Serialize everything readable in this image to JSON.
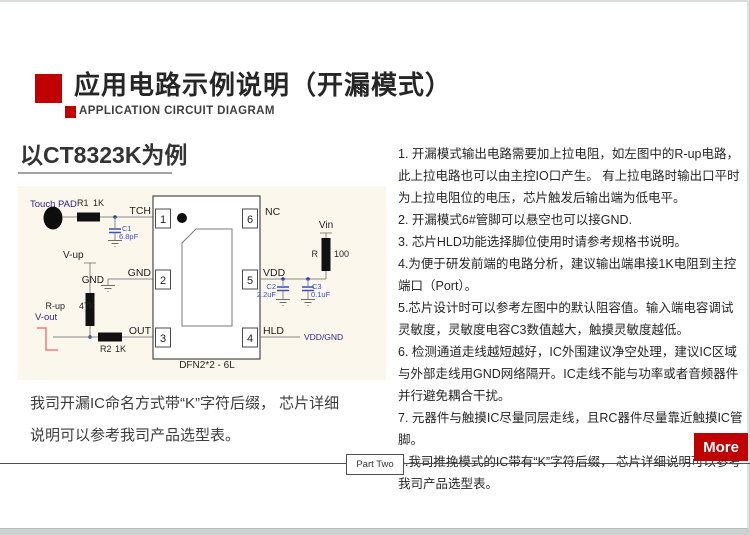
{
  "header": {
    "title": "应用电路示例说明（开漏模式）",
    "subtitle": "APPLICATION CIRCUIT DIAGRAM"
  },
  "left": {
    "heading": "以CT8323K为例",
    "caption_lines": [
      "我司开漏IC命名方式带“K”字符后缀， 芯片详细",
      "说明可以参考我司产品选型表。"
    ]
  },
  "notes": [
    "1. 开漏模式输出电路需要加上拉电阻，如左图中的R-up电路，此上拉电路也可以由主控IO口产生。 有上拉电路时输出口平时为上拉电阻位的电压，芯片触发后输出端为低电平。",
    "2. 开漏模式6#管脚可以悬空也可以接GND.",
    "3. 芯片HLD功能选择脚位使用时请参考规格书说明。",
    "4.为便于研发前端的电路分析，建议输出端串接1K电阻到主控端口（Port）。",
    "5.芯片设计时可以参考左图中的默认阻容值。输入端电容调试灵敏度，灵敏度电容C3数值越大，触摸灵敏度越低。",
    "6. 检测通道走线越短越好，IC外围建议净空处理，建议IC区域与外部走线用GND网络隔开。IC走线不能与功率或者音频器件并行避免耦合干扰。",
    "7. 元器件与触摸IC尽量同层走线，且RC器件尽量靠近触摸IC管脚。",
    "8.我司推挽模式的IC带有“K”字符后缀， 芯片详细说明可以参考我司产品选型表。"
  ],
  "footer": {
    "part_label": "Part Two",
    "more_label": "More"
  },
  "circuit": {
    "package_label": "DFN2*2 - 6L",
    "pins": {
      "p1": {
        "num": "1",
        "name": "TCH"
      },
      "p2": {
        "num": "2",
        "name": "GND"
      },
      "p3": {
        "num": "3",
        "name": "OUT"
      },
      "p4": {
        "num": "4",
        "name": "HLD"
      },
      "p5": {
        "num": "5",
        "name": "VDD"
      },
      "p6": {
        "num": "6",
        "name": "NC"
      }
    },
    "labels": {
      "touch_pad": "Touch PAD",
      "v_up": "V-up",
      "v_out": "V-out",
      "gnd": "GND",
      "vin": "Vin",
      "vdd_gnd": "VDD/GND"
    },
    "components": {
      "r1": {
        "ref": "R1",
        "value": "1K"
      },
      "r2": {
        "ref": "R2",
        "value": "1K"
      },
      "r_up": {
        "ref": "R-up",
        "value": "47K"
      },
      "r_series": {
        "ref": "R",
        "value": "100"
      },
      "c1": {
        "ref": "C1",
        "value": "6.8pF"
      },
      "c2": {
        "ref": "C2",
        "value": "2.2uF"
      },
      "c3": {
        "ref": "C3",
        "value": "0.1uF"
      }
    }
  },
  "colors": {
    "accent_red": "#C00000",
    "waveform_red": "#F27D7D",
    "capacitor_blue": "#3A4FC0",
    "net_label_navy": "#28288C",
    "panel_cream": "#FCF7EC"
  }
}
